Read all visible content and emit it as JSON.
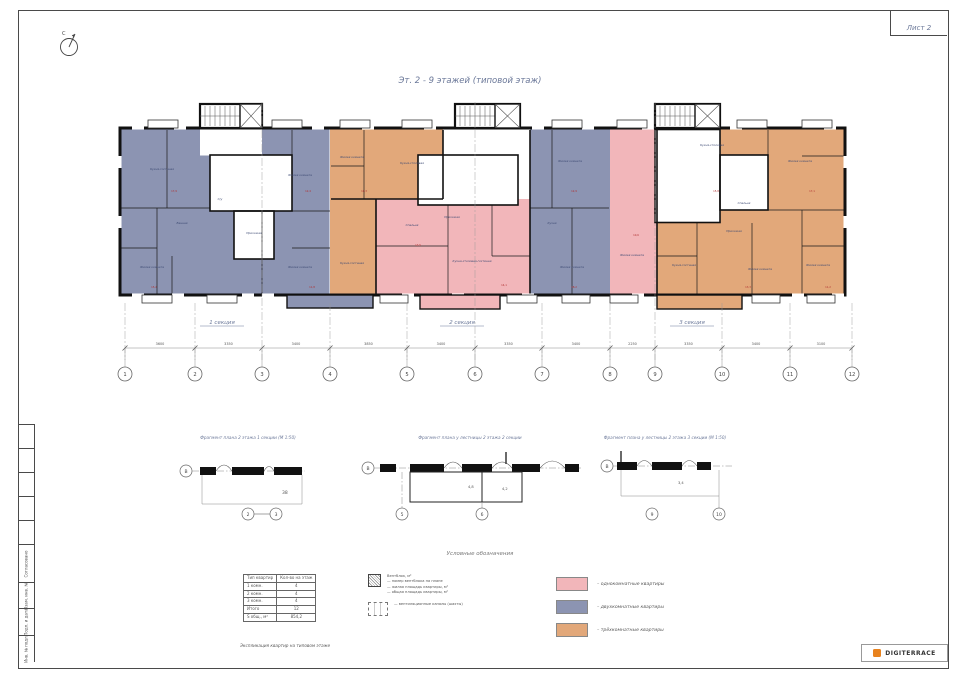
{
  "sheet": {
    "number_label": "Лист 2",
    "title": "Эт. 2 - 9 этажей (типовой этаж)",
    "north_label": "С"
  },
  "plan": {
    "section_labels": [
      "1 секция",
      "2 секция",
      "3 секция"
    ],
    "axes": [
      {
        "n": "1",
        "x": 13
      },
      {
        "n": "2",
        "x": 83
      },
      {
        "n": "3",
        "x": 150
      },
      {
        "n": "4",
        "x": 218
      },
      {
        "n": "5",
        "x": 295
      },
      {
        "n": "6",
        "x": 363
      },
      {
        "n": "7",
        "x": 430
      },
      {
        "n": "8",
        "x": 498
      },
      {
        "n": "9",
        "x": 543
      },
      {
        "n": "10",
        "x": 610
      },
      {
        "n": "11",
        "x": 678
      },
      {
        "n": "12",
        "x": 740
      }
    ],
    "dims": [
      "3600",
      "3350",
      "3400",
      "3850",
      "3400",
      "3350",
      "3400",
      "2250",
      "3350",
      "3400",
      "3100"
    ],
    "rooms": [
      {
        "t": "Кухня-гостиная",
        "x": 50,
        "y": 74
      },
      {
        "t": "Жилая комната",
        "x": 40,
        "y": 172
      },
      {
        "t": "Жилая комната",
        "x": 188,
        "y": 80
      },
      {
        "t": "Жилая комната",
        "x": 188,
        "y": 172
      },
      {
        "t": "Прихожая",
        "x": 142,
        "y": 138
      },
      {
        "t": "С/у",
        "x": 108,
        "y": 104
      },
      {
        "t": "Ванная",
        "x": 70,
        "y": 128
      },
      {
        "t": "Жилая комната",
        "x": 240,
        "y": 62
      },
      {
        "t": "Кухня-столовая",
        "x": 300,
        "y": 68
      },
      {
        "t": "Кухня-гостиная",
        "x": 240,
        "y": 168
      },
      {
        "t": "Спальня",
        "x": 300,
        "y": 130
      },
      {
        "t": "Кухня-столовая-гостиная",
        "x": 360,
        "y": 166
      },
      {
        "t": "Прихожая",
        "x": 340,
        "y": 122
      },
      {
        "t": "Жилая комната",
        "x": 458,
        "y": 66
      },
      {
        "t": "Кухня",
        "x": 440,
        "y": 128
      },
      {
        "t": "Жилая комната",
        "x": 460,
        "y": 172
      },
      {
        "t": "Жилая комната",
        "x": 520,
        "y": 160
      },
      {
        "t": "Кухня-столовая",
        "x": 600,
        "y": 50
      },
      {
        "t": "Жилая комната",
        "x": 688,
        "y": 66
      },
      {
        "t": "Спальня",
        "x": 632,
        "y": 108
      },
      {
        "t": "Прихожая",
        "x": 622,
        "y": 136
      },
      {
        "t": "Кухня-гостиная",
        "x": 572,
        "y": 170
      },
      {
        "t": "Жилая комната",
        "x": 648,
        "y": 174
      },
      {
        "t": "Жилая комната",
        "x": 706,
        "y": 170
      }
    ],
    "marks": [
      {
        "t": "17,9",
        "x": 62,
        "y": 96
      },
      {
        "t": "12,4",
        "x": 196,
        "y": 96
      },
      {
        "t": "15,2",
        "x": 42,
        "y": 192
      },
      {
        "t": "11,8",
        "x": 200,
        "y": 192
      },
      {
        "t": "16,3",
        "x": 252,
        "y": 96
      },
      {
        "t": "13,5",
        "x": 306,
        "y": 150
      },
      {
        "t": "14,1",
        "x": 392,
        "y": 190
      },
      {
        "t": "12,9",
        "x": 462,
        "y": 96
      },
      {
        "t": "18,2",
        "x": 462,
        "y": 192
      },
      {
        "t": "10,6",
        "x": 524,
        "y": 140
      },
      {
        "t": "15,8",
        "x": 604,
        "y": 96
      },
      {
        "t": "17,1",
        "x": 700,
        "y": 96
      },
      {
        "t": "13,3",
        "x": 636,
        "y": 192
      },
      {
        "t": "11,2",
        "x": 716,
        "y": 192
      }
    ]
  },
  "details": [
    {
      "title": "Фрагмент плана 2 этажа 1 секции (М 1:50)",
      "left_axis": "В",
      "bottom_axes": [
        "2",
        "3"
      ],
      "dim": "38",
      "room_areas": []
    },
    {
      "title": "Фрагмент плана у лестницы 2 этажа 2 секции",
      "left_axis": "В",
      "bottom_axes": [
        "5",
        "6"
      ],
      "dim": "",
      "room_areas": [
        "4,8",
        "4,2"
      ]
    },
    {
      "title": "Фрагмент плана у лестницы 2 этажа 3 секции (М 1:50)",
      "left_axis": "В",
      "bottom_axes": [
        "9",
        "10"
      ],
      "dim": "3,4",
      "room_areas": []
    }
  ],
  "apartment_table": {
    "caption": "Экспликация квартир на типовом этаже",
    "header": [
      "Тип квартир",
      "Кол-во на этаж"
    ],
    "rows": [
      [
        "1 комн.",
        "4"
      ],
      [
        "2 комн.",
        "4"
      ],
      [
        "3 комн.",
        "4"
      ],
      [
        "Итого",
        "12"
      ],
      [
        "S общ., м²",
        "854,2"
      ]
    ]
  },
  "symbols": {
    "title": "Условные обозначения",
    "hatch_note_lines": [
      "Вентблок, м²",
      "— номер вентблока на плане",
      "— жилая площадь квартиры, м²",
      "— общая площадь квартиры, м²"
    ],
    "duct_note": "— вентиляционные каналы (шахты)"
  },
  "legend": {
    "items": [
      {
        "label": "– однокомнатные квартиры",
        "color": "#F2B6BA"
      },
      {
        "label": "– двухкомнатные квартиры",
        "color": "#8C94B2"
      },
      {
        "label": "– трёхкомнатные квартиры",
        "color": "#E2A87A"
      }
    ]
  },
  "stamp": {
    "cells": [
      "",
      "",
      "",
      "",
      "",
      "Согласовано",
      "Взам. инв. №",
      "Подп. и дата",
      "Инв. № подл."
    ]
  },
  "logo": {
    "text": "DIGITERRACE"
  },
  "colors": {
    "one_room": "#F2B6BA",
    "two_room": "#8C94B2",
    "three_room": "#E2A87A"
  }
}
